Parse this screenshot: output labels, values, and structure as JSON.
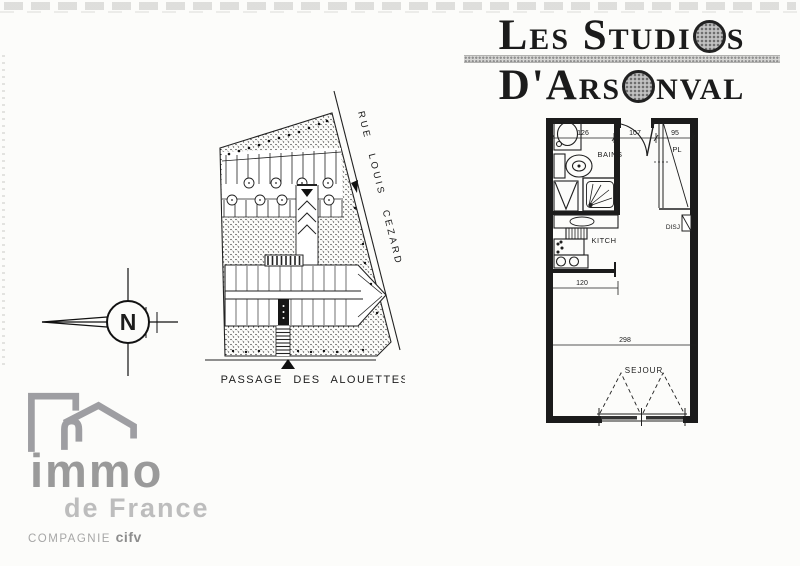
{
  "title": {
    "text": "LES STUDIOS D'ARSONVAL",
    "line1": {
      "pre": "Les Studi",
      "o": "O",
      "post": "s"
    },
    "line2": {
      "pre": "D'Ars",
      "o": "O",
      "post": "nval"
    }
  },
  "site_plan": {
    "street_label": "RUE LOUIS CEZARD",
    "passage_label": "PASSAGE DES ALOUETTES"
  },
  "compass": {
    "north_label": "N"
  },
  "floor_plan": {
    "rooms": [
      "BAINS",
      "PL",
      "DISJ",
      "KITCH",
      "SEJOUR"
    ],
    "dims": [
      "126",
      "107",
      "95",
      "120",
      "298"
    ]
  },
  "logo": {
    "brand": "immo",
    "region": "de France",
    "company_prefix": "COMPAGNIE",
    "company_name": "cifv"
  },
  "colors": {
    "ink": "#1c1c1c",
    "paper": "#fcfcfa",
    "logo_gray": "#9e9ea2",
    "halftone_gray": "#8f8f8f"
  }
}
